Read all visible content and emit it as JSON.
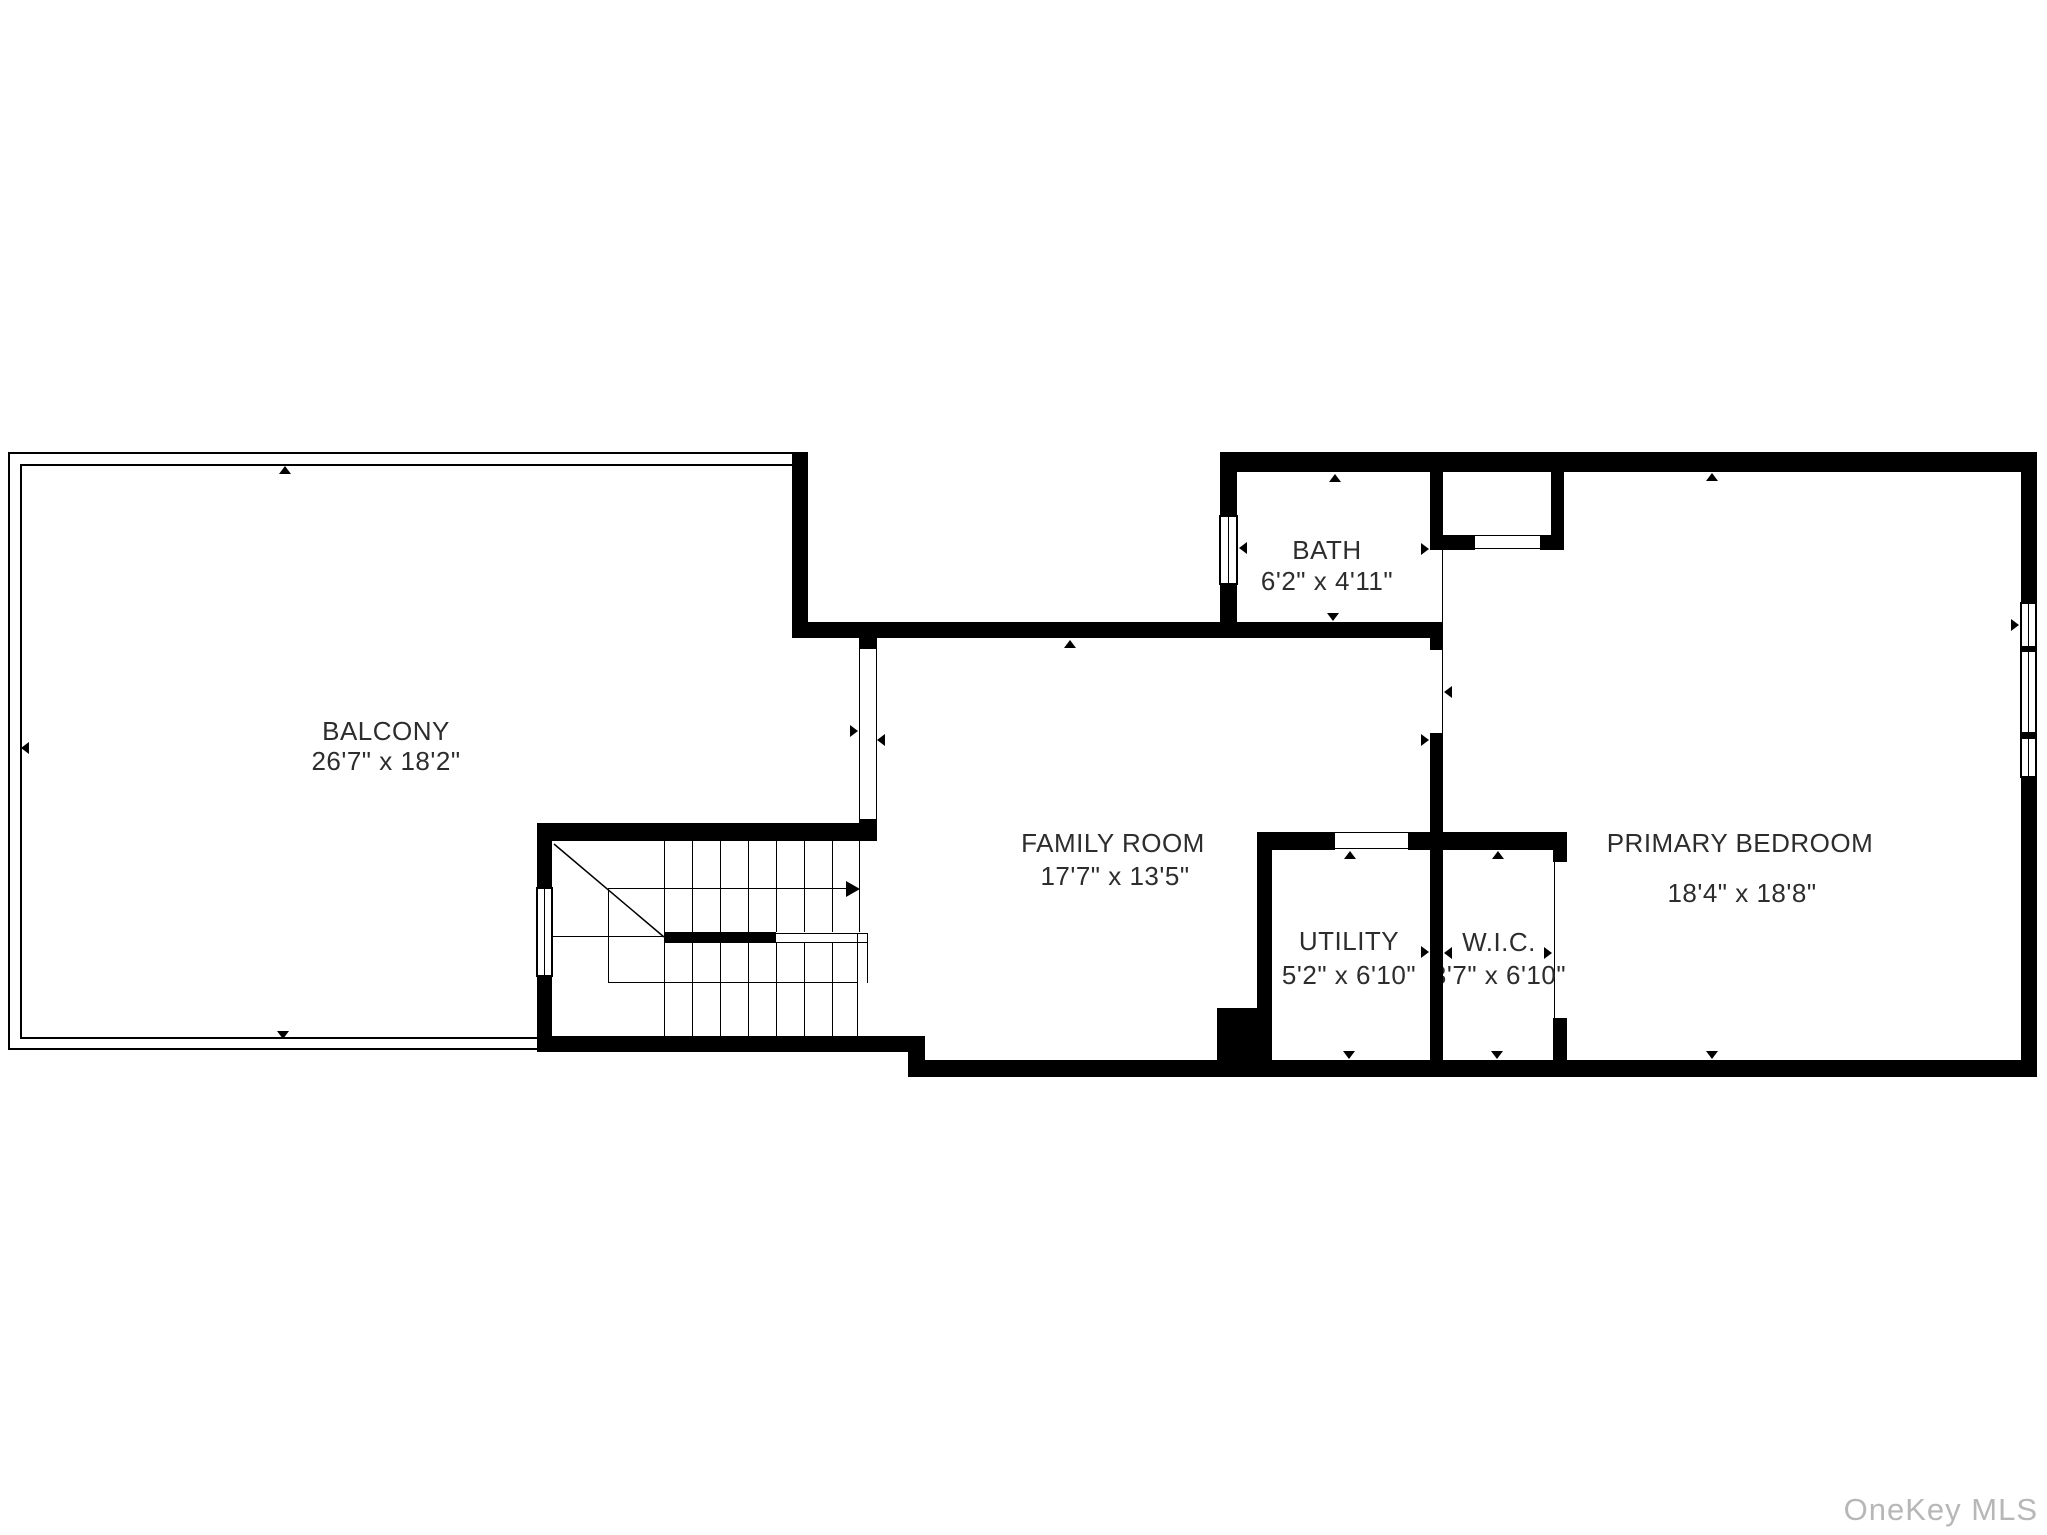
{
  "plan": {
    "type": "floor-plan",
    "wall_color": "#000000",
    "label_color": "#2d2d2d",
    "watermark": "OneKey MLS",
    "watermark_color": "#b7b7b7",
    "rooms": {
      "balcony": {
        "label": "BALCONY",
        "dims": "26'7\" x 18'2\""
      },
      "family_room": {
        "label": "FAMILY ROOM",
        "dims": "17'7\" x 13'5\""
      },
      "bath": {
        "label": "BATH",
        "dims": "6'2\" x 4'11\""
      },
      "utility": {
        "label": "UTILITY",
        "dims": "5'2\" x 6'10\""
      },
      "wic": {
        "label": "W.I.C.",
        "dims": "3'7\" x 6'10\""
      },
      "primary_bedroom": {
        "label": "PRIMARY BEDROOM",
        "dims": "18'4\" x 18'8\""
      }
    },
    "symbols": {
      "staircase": "u-shaped stairs with up direction arrow",
      "windows": [
        "stair-left-wall",
        "bath-left-wall",
        "primary-bedroom-right-wall"
      ]
    }
  }
}
